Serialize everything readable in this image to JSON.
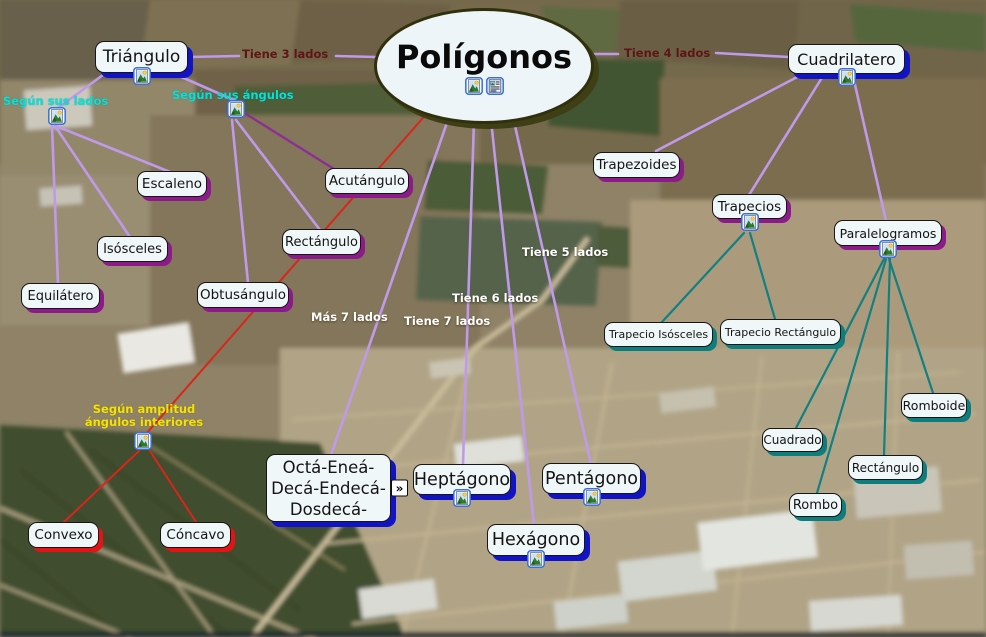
{
  "central_node": {
    "label": "Polígonos"
  },
  "nodes": {
    "triangulo": "Triángulo",
    "cuadrilatero": "Cuadrilatero",
    "escaleno": "Escaleno",
    "isosceles": "Isósceles",
    "equilatero": "Equilátero",
    "acutangulo": "Acutángulo",
    "rectangulo_tri": "Rectángulo",
    "obtusangulo": "Obtusángulo",
    "trapezoides": "Trapezoides",
    "trapecios": "Trapecios",
    "paralelogramos": "Paralelogramos",
    "trapecio_isosceles": "Trapecio Isósceles",
    "trapecio_rectangulo": "Trapecio Rectángulo",
    "romboide": "Romboide",
    "cuadrado": "Cuadrado",
    "rectangulo_cuad": "Rectángulo",
    "rombo": "Rombo",
    "convexo": "Convexo",
    "concavo": "Cóncavo",
    "heptagono": "Heptágono",
    "pentagono": "Pentágono",
    "hexagono": "Hexágono"
  },
  "octa_node_lines": [
    "Octá-Eneá-",
    "Decá-Endecá-",
    "Dosdecá-"
  ],
  "edge_labels": {
    "tiene3": "Tiene 3 lados",
    "tiene4": "Tiene 4 lados",
    "tiene5": "Tiene 5 lados",
    "tiene6": "Tiene 6 lados",
    "tiene7": "Tiene 7 lados",
    "mas7": "Más 7 lados"
  },
  "category_labels": {
    "segun_lados": "Según sus lados",
    "segun_angulos": "Según sus ángulos",
    "segun_amplitud_1": "Según amplitud",
    "segun_amplitud_2": "ángulos interiores"
  },
  "icons": {
    "image": "image-icon",
    "note": "note-icon",
    "collapse": "collapse-chevron-icon",
    "collapse_glyph": "»"
  },
  "colors": {
    "branch_line_plum": "#c09aea",
    "branch_line_dark_purple": "#8c2f94",
    "branch_line_teal": "#118080",
    "branch_line_red": "#da251a",
    "node_fill": "#f0f7f9",
    "shadow_blue": "#1313c6",
    "shadow_purple": "#8c1b89",
    "shadow_teal": "#0d7d7d",
    "shadow_red": "#e41414",
    "ellipse_border": "#30300d",
    "label_maroon": "#5e1515",
    "label_cyan": "#00e4da",
    "label_yellow": "#f4e400",
    "label_white": "#ffffff"
  }
}
